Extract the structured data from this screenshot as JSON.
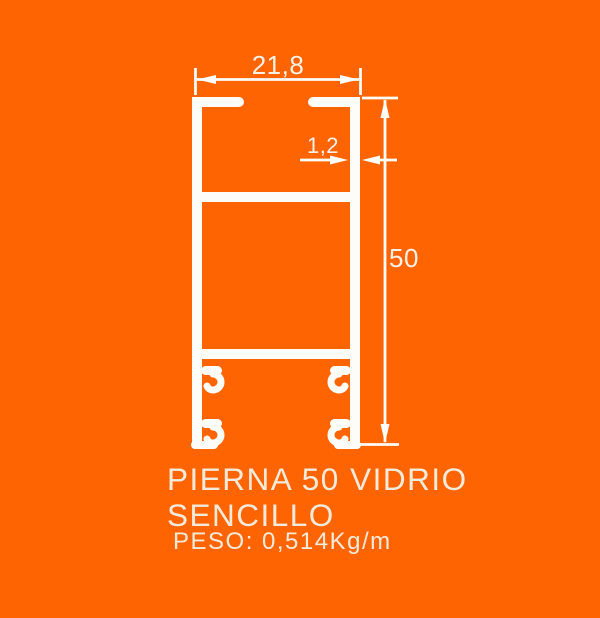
{
  "colors": {
    "background": "#fe6502",
    "drawing": "#fdfcf8",
    "dim_text": "#f7f2e8",
    "title_text": "#f2ebdc"
  },
  "dimensions": {
    "top_width": "21,8",
    "wall_thickness": "1,2",
    "height": "50"
  },
  "title": {
    "line1": "PIERNA 50 VIDRIO",
    "line2": "SENCILLO",
    "weight": "PESO: 0,514Kg/m"
  }
}
